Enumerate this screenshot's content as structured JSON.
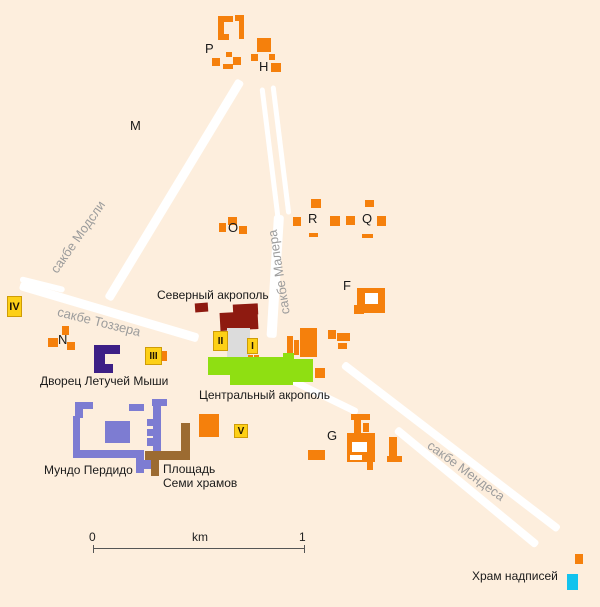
{
  "map": {
    "colors": {
      "orange": "#f5800c",
      "darkred": "#8e1a10",
      "plaza": "#dcdcdc",
      "green": "#8fdf12",
      "blue": "#7d7cd2",
      "brown": "#9c6b31",
      "cyan": "#12c3ee",
      "yellow": "#fdd017",
      "yellow_border": "#cf9c06",
      "hole": "#ffffff",
      "road": "#ffffff",
      "text": "#1a1a1a",
      "road_text": "#9c9c9c"
    },
    "roads": [
      {
        "name": "causeway-maudslay",
        "x": 108,
        "y": 299,
        "len": 256,
        "w": 9,
        "angle": -58.8
      },
      {
        "name": "causeway-tozzer",
        "x": 20,
        "y": 285,
        "len": 186,
        "w": 9,
        "angle": 16.5
      },
      {
        "name": "causeway-tozzer-start",
        "x": 20,
        "y": 279,
        "len": 46,
        "w": 6,
        "angle": 14
      },
      {
        "name": "causeway-maler-left",
        "x": 262,
        "y": 87,
        "len": 137,
        "w": 5,
        "angle": 83
      },
      {
        "name": "causeway-maler-right",
        "x": 273,
        "y": 85,
        "len": 130,
        "w": 5,
        "angle": 83
      },
      {
        "name": "causeway-maler-lower",
        "x": 279,
        "y": 215,
        "len": 123,
        "w": 10,
        "angle": 93.5
      },
      {
        "name": "causeway-mendes-upper",
        "x": 343,
        "y": 364,
        "len": 272,
        "w": 8,
        "angle": 37.5
      },
      {
        "name": "causeway-mendes-lower-1",
        "x": 292,
        "y": 380,
        "len": 73,
        "w": 7,
        "angle": 26
      },
      {
        "name": "causeway-mendes-lower-2",
        "x": 396,
        "y": 429,
        "len": 183,
        "w": 8,
        "angle": 39.5
      }
    ],
    "structures": [
      {
        "name": "group-P-bracket-top",
        "x": 218,
        "y": 16,
        "w": 15,
        "h": 6,
        "c": "orange"
      },
      {
        "name": "group-P-bracket-left",
        "x": 218,
        "y": 16,
        "w": 6,
        "h": 24,
        "c": "orange"
      },
      {
        "name": "group-P-bracket-bottom",
        "x": 218,
        "y": 34,
        "w": 11,
        "h": 6,
        "c": "orange"
      },
      {
        "name": "group-P-top-right-bar",
        "x": 235,
        "y": 15,
        "w": 9,
        "h": 6,
        "c": "orange"
      },
      {
        "name": "group-P-right-wall",
        "x": 239,
        "y": 15,
        "w": 5,
        "h": 24,
        "c": "orange"
      },
      {
        "name": "group-P-mound-1",
        "x": 226,
        "y": 52,
        "w": 6,
        "h": 5,
        "c": "orange"
      },
      {
        "name": "group-P-mound-2",
        "x": 212,
        "y": 58,
        "w": 8,
        "h": 8,
        "c": "orange"
      },
      {
        "name": "group-P-mound-3",
        "x": 223,
        "y": 64,
        "w": 10,
        "h": 5,
        "c": "orange"
      },
      {
        "name": "group-P-mound-4",
        "x": 233,
        "y": 57,
        "w": 8,
        "h": 8,
        "c": "orange"
      },
      {
        "name": "group-H-pyramid",
        "x": 257,
        "y": 38,
        "w": 14,
        "h": 14,
        "c": "orange"
      },
      {
        "name": "group-H-mound-1",
        "x": 251,
        "y": 54,
        "w": 7,
        "h": 7,
        "c": "orange"
      },
      {
        "name": "group-H-mound-2",
        "x": 269,
        "y": 54,
        "w": 6,
        "h": 6,
        "c": "orange"
      },
      {
        "name": "group-H-mound-3",
        "x": 271,
        "y": 63,
        "w": 10,
        "h": 9,
        "c": "orange"
      },
      {
        "name": "group-O-mound-1",
        "x": 219,
        "y": 223,
        "w": 7,
        "h": 9,
        "c": "orange"
      },
      {
        "name": "group-O-mound-2",
        "x": 228,
        "y": 217,
        "w": 9,
        "h": 8,
        "c": "orange"
      },
      {
        "name": "group-O-mound-3",
        "x": 239,
        "y": 226,
        "w": 8,
        "h": 8,
        "c": "orange"
      },
      {
        "name": "group-R-mound-top",
        "x": 311,
        "y": 199,
        "w": 10,
        "h": 9,
        "c": "orange"
      },
      {
        "name": "group-R-mound-left",
        "x": 293,
        "y": 217,
        "w": 8,
        "h": 9,
        "c": "orange"
      },
      {
        "name": "group-R-mound-mid-1",
        "x": 330,
        "y": 216,
        "w": 10,
        "h": 10,
        "c": "orange"
      },
      {
        "name": "group-R-mound-mid-2",
        "x": 346,
        "y": 216,
        "w": 9,
        "h": 9,
        "c": "orange"
      },
      {
        "name": "group-Q-mound-top",
        "x": 365,
        "y": 200,
        "w": 9,
        "h": 7,
        "c": "orange"
      },
      {
        "name": "group-Q-mound-right",
        "x": 377,
        "y": 216,
        "w": 9,
        "h": 10,
        "c": "orange"
      },
      {
        "name": "group-R-bar-bottom",
        "x": 309,
        "y": 233,
        "w": 9,
        "h": 4,
        "c": "orange"
      },
      {
        "name": "group-Q-bar-bottom",
        "x": 362,
        "y": 234,
        "w": 11,
        "h": 4,
        "c": "orange"
      },
      {
        "name": "group-F-main",
        "x": 357,
        "y": 288,
        "w": 28,
        "h": 25,
        "c": "orange"
      },
      {
        "name": "group-F-step",
        "x": 354,
        "y": 305,
        "w": 10,
        "h": 9,
        "c": "orange"
      },
      {
        "name": "group-F-courtyard",
        "x": 365,
        "y": 293,
        "w": 13,
        "h": 11,
        "c": "hole"
      },
      {
        "name": "north-acropolis-mound",
        "x": 195,
        "y": 303,
        "w": 13,
        "h": 9,
        "c": "darkred",
        "r": -4
      },
      {
        "name": "north-acropolis-upper",
        "x": 233,
        "y": 304,
        "w": 25,
        "h": 11,
        "c": "darkred",
        "r": -3
      },
      {
        "name": "north-acropolis-lower",
        "x": 220,
        "y": 312,
        "w": 38,
        "h": 18,
        "c": "darkred",
        "r": -3
      },
      {
        "name": "great-plaza",
        "x": 227,
        "y": 328,
        "w": 23,
        "h": 29,
        "c": "plaza"
      },
      {
        "name": "east-plaza-bar-1",
        "x": 287,
        "y": 336,
        "w": 6,
        "h": 19,
        "c": "orange"
      },
      {
        "name": "east-plaza-bar-2",
        "x": 294,
        "y": 340,
        "w": 5,
        "h": 15,
        "c": "orange"
      },
      {
        "name": "east-plaza-main",
        "x": 300,
        "y": 328,
        "w": 17,
        "h": 29,
        "c": "orange"
      },
      {
        "name": "east-cluster-1",
        "x": 328,
        "y": 330,
        "w": 8,
        "h": 9,
        "c": "orange"
      },
      {
        "name": "east-cluster-2",
        "x": 337,
        "y": 333,
        "w": 13,
        "h": 8,
        "c": "orange"
      },
      {
        "name": "east-cluster-3",
        "x": 338,
        "y": 343,
        "w": 9,
        "h": 6,
        "c": "orange"
      },
      {
        "name": "temple-I-annex-1",
        "x": 248,
        "y": 355,
        "w": 5,
        "h": 7,
        "c": "orange"
      },
      {
        "name": "temple-I-annex-2",
        "x": 254,
        "y": 355,
        "w": 5,
        "h": 7,
        "c": "orange"
      },
      {
        "name": "central-acropolis-1",
        "x": 208,
        "y": 357,
        "w": 82,
        "h": 18,
        "c": "green"
      },
      {
        "name": "central-acropolis-2",
        "x": 230,
        "y": 372,
        "w": 63,
        "h": 13,
        "c": "green"
      },
      {
        "name": "central-acropolis-3",
        "x": 288,
        "y": 359,
        "w": 25,
        "h": 23,
        "c": "green"
      },
      {
        "name": "central-acropolis-4",
        "x": 283,
        "y": 353,
        "w": 11,
        "h": 7,
        "c": "green"
      },
      {
        "name": "east-plaza-south-mound",
        "x": 315,
        "y": 368,
        "w": 10,
        "h": 10,
        "c": "orange"
      },
      {
        "name": "group-N-mound-1",
        "x": 62,
        "y": 326,
        "w": 7,
        "h": 9,
        "c": "orange"
      },
      {
        "name": "group-N-mound-2",
        "x": 48,
        "y": 338,
        "w": 10,
        "h": 9,
        "c": "orange"
      },
      {
        "name": "group-N-mound-3",
        "x": 67,
        "y": 342,
        "w": 8,
        "h": 8,
        "c": "orange"
      },
      {
        "name": "temple-III-annex",
        "x": 158,
        "y": 351,
        "w": 9,
        "h": 10,
        "c": "orange"
      },
      {
        "name": "bat-palace-top",
        "x": 94,
        "y": 345,
        "w": 26,
        "h": 9,
        "c": "#3d1f86"
      },
      {
        "name": "bat-palace-left",
        "x": 94,
        "y": 345,
        "w": 11,
        "h": 28,
        "c": "#3d1f86"
      },
      {
        "name": "bat-palace-bottom",
        "x": 94,
        "y": 364,
        "w": 19,
        "h": 9,
        "c": "#3d1f86"
      },
      {
        "name": "mundo-perdido-hook-top",
        "x": 75,
        "y": 402,
        "w": 18,
        "h": 7,
        "c": "blue"
      },
      {
        "name": "mundo-perdido-hook-side",
        "x": 75,
        "y": 402,
        "w": 8,
        "h": 16,
        "c": "blue"
      },
      {
        "name": "mundo-perdido-west-wall",
        "x": 73,
        "y": 416,
        "w": 7,
        "h": 41,
        "c": "blue"
      },
      {
        "name": "mundo-perdido-south-wall",
        "x": 73,
        "y": 450,
        "w": 65,
        "h": 8,
        "c": "blue"
      },
      {
        "name": "mundo-perdido-pyramid",
        "x": 105,
        "y": 421,
        "w": 25,
        "h": 22,
        "c": "blue"
      },
      {
        "name": "mundo-perdido-north-bar",
        "x": 129,
        "y": 404,
        "w": 15,
        "h": 7,
        "c": "blue"
      },
      {
        "name": "mundo-perdido-east-cap",
        "x": 152,
        "y": 399,
        "w": 15,
        "h": 7,
        "c": "blue"
      },
      {
        "name": "mundo-perdido-east-wall",
        "x": 153,
        "y": 400,
        "w": 8,
        "h": 51,
        "c": "blue"
      },
      {
        "name": "mundo-perdido-step-1",
        "x": 147,
        "y": 419,
        "w": 6,
        "h": 7,
        "c": "blue"
      },
      {
        "name": "mundo-perdido-step-2",
        "x": 147,
        "y": 429,
        "w": 6,
        "h": 7,
        "c": "blue"
      },
      {
        "name": "mundo-perdido-step-3",
        "x": 147,
        "y": 438,
        "w": 6,
        "h": 8,
        "c": "blue"
      },
      {
        "name": "mundo-perdido-south-stem",
        "x": 136,
        "y": 450,
        "w": 8,
        "h": 23,
        "c": "blue"
      },
      {
        "name": "mundo-perdido-south-foot",
        "x": 143,
        "y": 460,
        "w": 8,
        "h": 9,
        "c": "blue"
      },
      {
        "name": "seven-temples-east-wall",
        "x": 181,
        "y": 423,
        "w": 9,
        "h": 30,
        "c": "brown"
      },
      {
        "name": "seven-temples-south-wall",
        "x": 145,
        "y": 451,
        "w": 45,
        "h": 9,
        "c": "brown"
      },
      {
        "name": "seven-temples-stem",
        "x": 151,
        "y": 459,
        "w": 8,
        "h": 17,
        "c": "brown"
      },
      {
        "name": "temple-V-platform",
        "x": 199,
        "y": 414,
        "w": 20,
        "h": 23,
        "c": "orange"
      },
      {
        "name": "group-G-top-bar",
        "x": 351,
        "y": 414,
        "w": 19,
        "h": 6,
        "c": "orange"
      },
      {
        "name": "group-G-neck",
        "x": 354,
        "y": 420,
        "w": 7,
        "h": 17,
        "c": "orange"
      },
      {
        "name": "group-G-neck-side",
        "x": 363,
        "y": 423,
        "w": 6,
        "h": 9,
        "c": "orange"
      },
      {
        "name": "group-G-main",
        "x": 347,
        "y": 433,
        "w": 28,
        "h": 29,
        "c": "orange"
      },
      {
        "name": "group-G-court-1",
        "x": 352,
        "y": 442,
        "w": 15,
        "h": 10,
        "c": "hole"
      },
      {
        "name": "group-G-court-2",
        "x": 350,
        "y": 455,
        "w": 12,
        "h": 5,
        "c": "hole"
      },
      {
        "name": "group-G-stem",
        "x": 367,
        "y": 460,
        "w": 6,
        "h": 10,
        "c": "orange"
      },
      {
        "name": "group-G-east-bar",
        "x": 389,
        "y": 437,
        "w": 8,
        "h": 21,
        "c": "orange"
      },
      {
        "name": "group-G-east-foot",
        "x": 387,
        "y": 456,
        "w": 15,
        "h": 6,
        "c": "orange"
      },
      {
        "name": "group-G-west-bar",
        "x": 308,
        "y": 450,
        "w": 17,
        "h": 10,
        "c": "orange"
      },
      {
        "name": "southeast-mound",
        "x": 575,
        "y": 554,
        "w": 8,
        "h": 10,
        "c": "orange"
      },
      {
        "name": "temple-of-inscriptions-marker",
        "x": 567,
        "y": 574,
        "w": 11,
        "h": 16,
        "c": "cyan"
      }
    ],
    "temples": [
      {
        "label": "IV",
        "x": 7,
        "y": 296,
        "w": 15,
        "h": 21,
        "fs": 11
      },
      {
        "label": "III",
        "x": 145,
        "y": 347,
        "w": 17,
        "h": 18,
        "fs": 10
      },
      {
        "label": "II",
        "x": 213,
        "y": 331,
        "w": 15,
        "h": 20,
        "fs": 10
      },
      {
        "label": "I",
        "x": 247,
        "y": 338,
        "w": 11,
        "h": 16,
        "fs": 10
      },
      {
        "label": "V",
        "x": 234,
        "y": 424,
        "w": 14,
        "h": 14,
        "fs": 10
      }
    ],
    "letters": [
      {
        "text": "P",
        "x": 205,
        "y": 42
      },
      {
        "text": "H",
        "x": 259,
        "y": 60
      },
      {
        "text": "M",
        "x": 130,
        "y": 119
      },
      {
        "text": "O",
        "x": 228,
        "y": 221
      },
      {
        "text": "R",
        "x": 308,
        "y": 212
      },
      {
        "text": "Q",
        "x": 362,
        "y": 212
      },
      {
        "text": "F",
        "x": 343,
        "y": 279
      },
      {
        "text": "N",
        "x": 58,
        "y": 333
      },
      {
        "text": "G",
        "x": 327,
        "y": 429
      }
    ],
    "labels": [
      {
        "name": "label-north-acropolis",
        "text": "Северный акрополь",
        "x": 157,
        "y": 289
      },
      {
        "name": "label-central-acropolis",
        "text": "Центральный акрополь",
        "x": 199,
        "y": 389
      },
      {
        "name": "label-bat-palace",
        "text": "Дворец Летучей Мыши",
        "x": 40,
        "y": 375
      },
      {
        "name": "label-mundo-perdido",
        "text": "Мундо Пердидо",
        "x": 44,
        "y": 464
      },
      {
        "name": "label-seven-plaza-1",
        "text": "Площадь",
        "x": 163,
        "y": 463
      },
      {
        "name": "label-seven-plaza-2",
        "text": "Семи храмов",
        "x": 163,
        "y": 477
      },
      {
        "name": "label-inscriptions",
        "text": "Храм надписей",
        "x": 472,
        "y": 570
      }
    ],
    "road_labels": [
      {
        "name": "label-causeway-maudslay",
        "text": "сакбе Модсли",
        "cx": 78,
        "cy": 237,
        "rot": -55
      },
      {
        "name": "label-causeway-tozzer",
        "text": "сакбе Тоззера",
        "cx": 99,
        "cy": 322,
        "rot": 14
      },
      {
        "name": "label-causeway-maler",
        "text": "сакбе Малера",
        "cx": 279,
        "cy": 272,
        "rot": -99
      },
      {
        "name": "label-causeway-mendes",
        "text": "сакбе Мендеса",
        "cx": 466,
        "cy": 471,
        "rot": 36
      }
    ],
    "scalebar": {
      "x": 93,
      "y": 548,
      "w": 211,
      "tick_h": 8,
      "start": "0",
      "unit": "km",
      "end": "1",
      "start_x": 89,
      "unit_x": 192,
      "end_x": 299,
      "num_y": 530
    }
  }
}
